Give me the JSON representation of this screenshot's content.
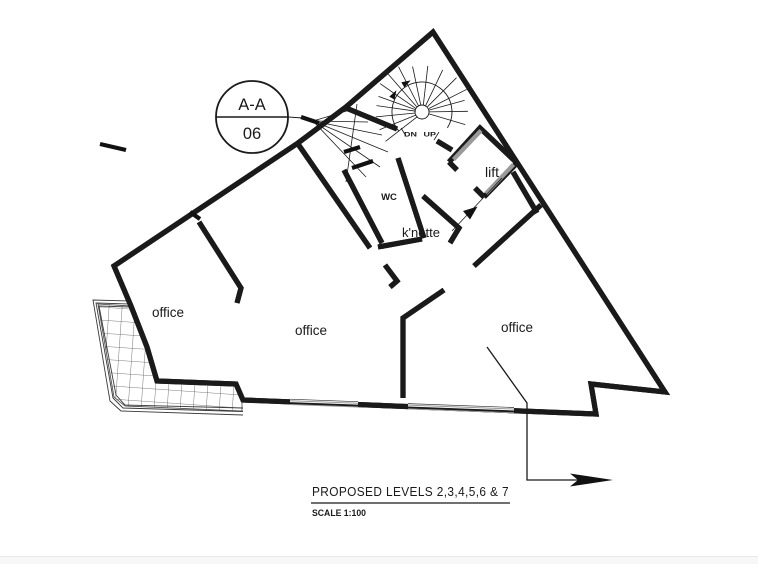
{
  "drawing": {
    "section_marker": {
      "label": "A-A",
      "number": "06"
    },
    "stair": {
      "direction_label": "DN UP"
    },
    "rooms": {
      "offices": [
        "office",
        "office",
        "office"
      ],
      "wc": "WC",
      "kitchenette": "k'nette",
      "lift": "lift"
    },
    "title_block": {
      "title": "PROPOSED LEVELS 2,3,4,5,6 & 7",
      "scale": "SCALE 1:100"
    },
    "colors": {
      "line": "#1a1a1a",
      "wall_gray": "#9a9a9a",
      "hatch": "#555555",
      "background": "#ffffff"
    }
  }
}
